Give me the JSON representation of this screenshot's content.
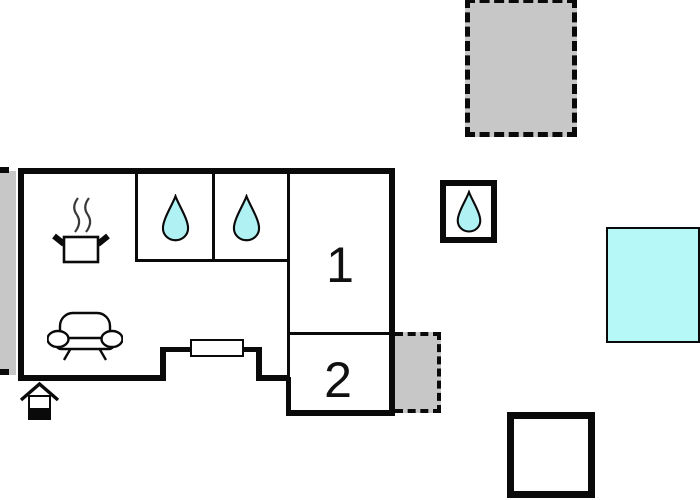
{
  "floorplan": {
    "rooms": [
      {
        "id": "room-1",
        "label": "1"
      },
      {
        "id": "room-2",
        "label": "2"
      }
    ],
    "icons": {
      "kitchen": "cooking-pot-steam-icon",
      "bathroom_cell_1": "water-drop-icon",
      "bathroom_cell_2": "water-drop-icon",
      "shower_outbuilding": "water-drop-icon",
      "living_room": "sofa-icon",
      "entrance": "house-entrance-icon"
    },
    "colors": {
      "wall": "#0a0a0a",
      "gray_fill": "#c7c7c7",
      "drop_cyan": "#b0f2f4",
      "pool_cyan": "#b6f8f8",
      "background": "#ffffff"
    }
  }
}
